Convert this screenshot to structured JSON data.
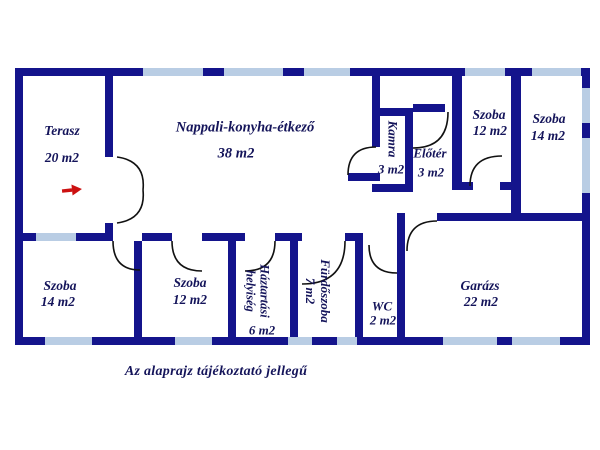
{
  "plan": {
    "caption": "Az alaprajz tájékoztató jellegű",
    "colors": {
      "wall": "#14148c",
      "window": "#b9cde4",
      "door": "#111111",
      "label": "#14145a",
      "arrow": "#cc1111",
      "bg": "#ffffff"
    },
    "rooms": {
      "terasz": {
        "name": "Terasz",
        "area": "20 m2"
      },
      "nappali": {
        "name": "Nappali-konyha-étkező",
        "area": "38 m2"
      },
      "kamra": {
        "name": "Kamra",
        "area": "3 m2"
      },
      "eloter": {
        "name": "Előtér",
        "area": "3 m2"
      },
      "szoba12_top": {
        "name": "Szoba",
        "area": "12 m2"
      },
      "szoba14_top": {
        "name": "Szoba",
        "area": "14 m2"
      },
      "szoba14_bottom": {
        "name": "Szoba",
        "area": "14 m2"
      },
      "szoba12_bottom": {
        "name": "Szoba",
        "area": "12 m2"
      },
      "haztartasi": {
        "name_line1": "Háztartási",
        "name_line2": "helyiség",
        "area": "6 m2"
      },
      "furdoszoba": {
        "name": "Fürdőszoba",
        "area": "7 m2"
      },
      "wc": {
        "name": "WC",
        "area": "2 m2"
      },
      "garazs": {
        "name": "Garázs",
        "area": "22 m2"
      }
    }
  }
}
